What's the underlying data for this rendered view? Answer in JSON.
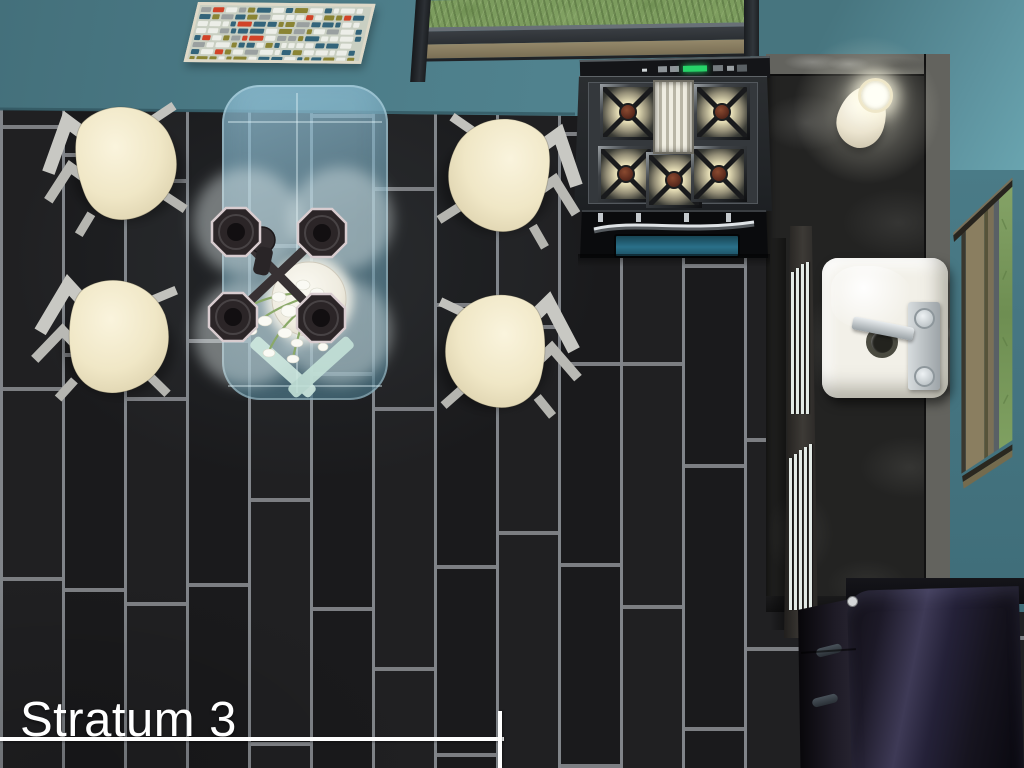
{
  "caption": {
    "title": "Stratum 3"
  },
  "scene": {
    "view": "overhead-room-view",
    "room": "kitchen-and-dining-room"
  },
  "palette": {
    "wall_teal": "#4e808d",
    "floor_tile": "#1b1b1d",
    "floor_grout": "#84878b",
    "counter_marble": "#232322",
    "counter_edge_light": "#63635e",
    "cabinet_handle": "#e3eae6",
    "stove_led_green": "#27d468",
    "oven_glass_teal": "#2a7089",
    "sink_white": "#f2f0e8",
    "fridge_black": "#1c1927",
    "chair_seat_cream": "#f3ecd4",
    "chair_frame_gray": "#c6c6c1",
    "table_glass_blue": "#98c8de",
    "lamp_glow": "#fffcE4",
    "grass_green": "#7c9c5e",
    "caption_white": "#ffffff"
  },
  "mosaic": {
    "palette": [
      "#8a8434",
      "#33647a",
      "#9aa0a0",
      "#eceee8",
      "#d14328"
    ],
    "background": "#c9cfc2",
    "frame": "#ded9c8"
  },
  "objects": [
    {
      "name": "mosaic-wall-art"
    },
    {
      "name": "north-window"
    },
    {
      "name": "east-window"
    },
    {
      "name": "glass-dining-table"
    },
    {
      "name": "ceiling-lamp-four-shades"
    },
    {
      "name": "flower-centerpiece"
    },
    {
      "name": "dining-chair",
      "count": 4
    },
    {
      "name": "gas-range-five-burners"
    },
    {
      "name": "counter-lamp"
    },
    {
      "name": "kitchen-sink"
    },
    {
      "name": "kitchen-counter"
    },
    {
      "name": "refrigerator"
    }
  ]
}
